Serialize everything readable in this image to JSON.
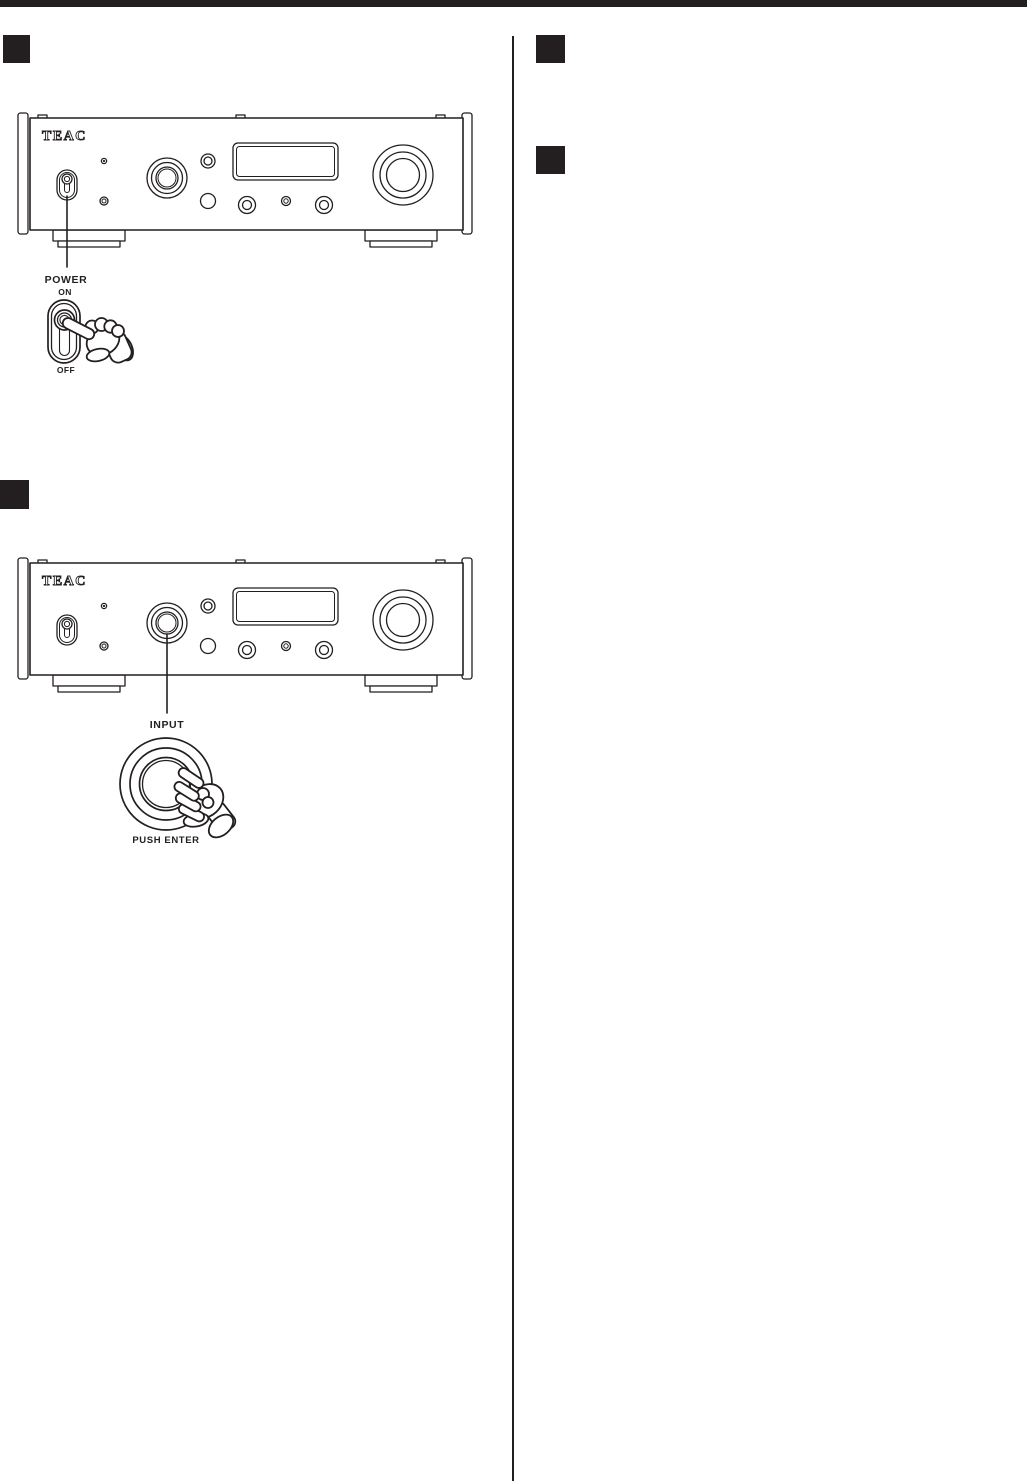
{
  "page": {
    "background": "#ffffff",
    "ink_color": "#231f20"
  },
  "device": {
    "brand": "TEAC"
  },
  "step1": {
    "label_power": "POWER",
    "label_on": "ON",
    "label_off": "OFF"
  },
  "step2": {
    "label_input": "INPUT",
    "label_push_enter": "PUSH ENTER"
  },
  "markers": {
    "style": "solid-black-square",
    "left_column_count": 2,
    "right_column_count": 2
  }
}
